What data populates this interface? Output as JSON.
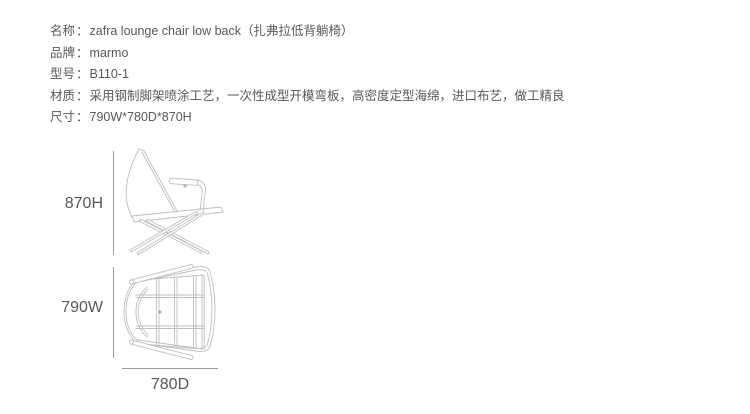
{
  "page": {
    "background": "#ffffff",
    "text_color": "#595959",
    "drawing_line_color": "#bfbfbf",
    "dimension_line_color": "#9c9c9c",
    "marker_color": "#cc8888"
  },
  "info": {
    "colon": "：",
    "rows": [
      {
        "key": "name",
        "label": "名称",
        "value": "zafra lounge chair low back（扎弗拉低背躺椅）"
      },
      {
        "key": "brand",
        "label": "品牌",
        "value": "marmo"
      },
      {
        "key": "model",
        "label": "型号",
        "value": "B110-1"
      },
      {
        "key": "material",
        "label": "材质",
        "value": "采用钢制脚架喷涂工艺，一次性成型开模弯板，高密度定型海绵，进口布艺，做工精良"
      },
      {
        "key": "size",
        "label": "尺寸",
        "value": "790W*780D*870H"
      }
    ]
  },
  "figures": {
    "side_view": {
      "height_label": "870H"
    },
    "top_view": {
      "width_label": "790W",
      "depth_label": "780D"
    }
  }
}
